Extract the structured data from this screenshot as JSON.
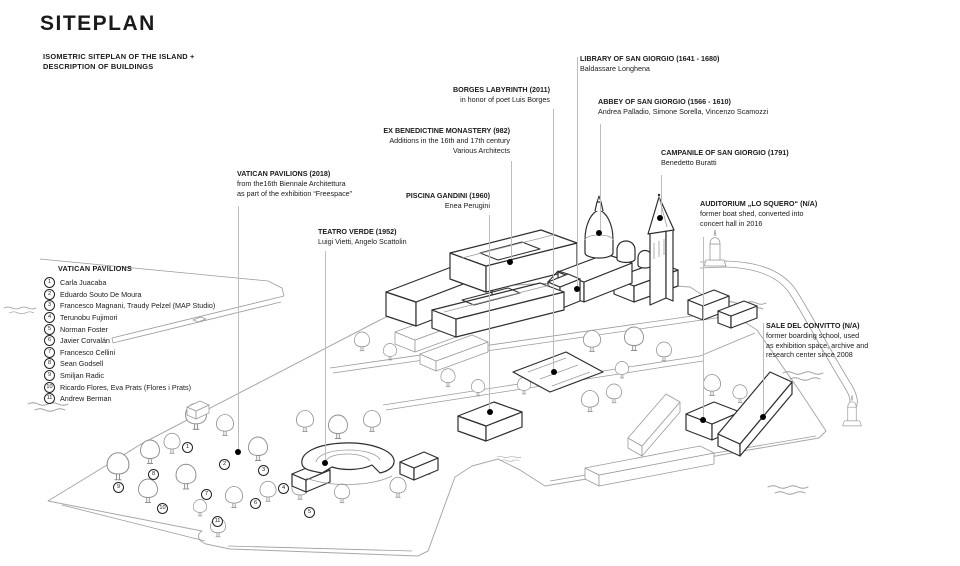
{
  "page": {
    "title": "SITEPLAN",
    "subtitle_line1": "ISOMETRIC SITEPLAN OF THE ISLAND +",
    "subtitle_line2": "DESCRIPTION OF BUILDINGS"
  },
  "colors": {
    "ink": "#1a1a1a",
    "bold_line": "#2e2e2e",
    "light_line": "#9b9b9b",
    "leader_line": "#bdbdbd",
    "dot": "#000000"
  },
  "labels": [
    {
      "id": "library",
      "title": "LIBRARY OF SAN GIORGIO (1641 - 1680)",
      "lines": [
        "Baldassare Longhena"
      ],
      "align": "left",
      "x": 580,
      "y": 54,
      "leader": {
        "x": 577,
        "y1": 57,
        "y2": 287
      },
      "dot": {
        "x": 577,
        "y": 289
      }
    },
    {
      "id": "abbey",
      "title": "ABBEY OF SAN GIORGIO (1566 - 1610)",
      "lines": [
        "Andrea Palladio, Simone Sorella, Vincenzo Scamozzi"
      ],
      "align": "left",
      "x": 598,
      "y": 97,
      "leader": {
        "x": 600,
        "y1": 124,
        "y2": 231
      },
      "dot": {
        "x": 599,
        "y": 233
      }
    },
    {
      "id": "campanile",
      "title": "CAMPANILE OF SAN GIORGIO (1791)",
      "lines": [
        "Benedetto Buratti"
      ],
      "align": "left",
      "x": 661,
      "y": 148,
      "leader": {
        "x": 661,
        "y1": 175,
        "y2": 216
      },
      "dot": {
        "x": 660,
        "y": 218
      }
    },
    {
      "id": "auditorium",
      "title": "AUDITORIUM „LO SQUERO“ (N/A)",
      "lines": [
        "former boat shed, converted into",
        "concert hall in 2016"
      ],
      "align": "left",
      "x": 700,
      "y": 199,
      "leader": {
        "x": 703,
        "y1": 237,
        "y2": 418
      },
      "dot": {
        "x": 703,
        "y": 420
      }
    },
    {
      "id": "sale",
      "title": "SALE DEL CONVITTO (N/A)",
      "lines": [
        "former boarding school, used",
        "as exhibition space, archive and",
        "research center since 2008"
      ],
      "align": "left",
      "x": 766,
      "y": 321,
      "leader": {
        "x": 763,
        "y1": 323,
        "y2": 414
      },
      "dot": {
        "x": 763,
        "y": 417
      }
    },
    {
      "id": "borges",
      "title": "BORGES LABYRINTH (2011)",
      "lines": [
        "in honor of poet Luis Borges"
      ],
      "align": "right",
      "right": 410,
      "y": 85,
      "leader": {
        "x": 553,
        "y1": 109,
        "y2": 369
      },
      "dot": {
        "x": 554,
        "y": 372
      }
    },
    {
      "id": "monastery",
      "title": "EX BENEDICTINE MONASTERY (982)",
      "lines": [
        "Additions in the 16th and 17th century",
        "Various Architects"
      ],
      "align": "right",
      "right": 450,
      "y": 126,
      "leader": {
        "x": 511,
        "y1": 161,
        "y2": 259
      },
      "dot": {
        "x": 510,
        "y": 262
      }
    },
    {
      "id": "piscina",
      "title": "PISCINA GANDINI (1960)",
      "lines": [
        "Enea Perugini"
      ],
      "align": "right",
      "right": 470,
      "y": 191,
      "leader": {
        "x": 489,
        "y1": 215,
        "y2": 409
      },
      "dot": {
        "x": 490,
        "y": 412
      }
    },
    {
      "id": "vatican",
      "title": "VATICAN PAVILIONS (2018)",
      "lines": [
        "from the16th Biennale Architettura",
        "as part of the exhibition “Freespace”"
      ],
      "align": "left",
      "x": 237,
      "y": 169,
      "leader": {
        "x": 238,
        "y1": 206,
        "y2": 449
      },
      "dot": {
        "x": 238,
        "y": 452
      }
    },
    {
      "id": "teatro",
      "title": "TEATRO VERDE (1952)",
      "lines": [
        "Luigi Vietti, Angelo Scattolin"
      ],
      "align": "left",
      "x": 318,
      "y": 227,
      "leader": {
        "x": 325,
        "y1": 251,
        "y2": 460
      },
      "dot": {
        "x": 325,
        "y": 463
      }
    }
  ],
  "legend": {
    "title": "VATICAN PAVILIONS",
    "x": 44,
    "y": 264,
    "items": [
      {
        "num": "1",
        "name": "Carla Juacaba"
      },
      {
        "num": "2",
        "name": "Eduardo Souto De Moura"
      },
      {
        "num": "3",
        "name": "Francesco Magnani, Traudy Pelzel (MAP Studio)"
      },
      {
        "num": "4",
        "name": "Terunobu Fujimori"
      },
      {
        "num": "5",
        "name": "Norman Foster"
      },
      {
        "num": "6",
        "name": "Javier Corvalán"
      },
      {
        "num": "7",
        "name": "Francesco Cellini"
      },
      {
        "num": "8",
        "name": "Sean Godsell"
      },
      {
        "num": "9",
        "name": "Smiljan Radic"
      },
      {
        "num": "10",
        "name": "Ricardo Flores, Eva Prats (Flores i Prats)"
      },
      {
        "num": "11",
        "name": "Andrew Berman"
      }
    ]
  },
  "map_markers": [
    {
      "num": "1",
      "x": 187,
      "y": 447
    },
    {
      "num": "2",
      "x": 224,
      "y": 464
    },
    {
      "num": "3",
      "x": 263,
      "y": 470
    },
    {
      "num": "4",
      "x": 283,
      "y": 488
    },
    {
      "num": "5",
      "x": 309,
      "y": 512
    },
    {
      "num": "6",
      "x": 255,
      "y": 503
    },
    {
      "num": "7",
      "x": 206,
      "y": 494
    },
    {
      "num": "8",
      "x": 153,
      "y": 474
    },
    {
      "num": "9",
      "x": 118,
      "y": 487
    },
    {
      "num": "10",
      "x": 162,
      "y": 508
    },
    {
      "num": "11",
      "x": 217,
      "y": 521
    }
  ]
}
